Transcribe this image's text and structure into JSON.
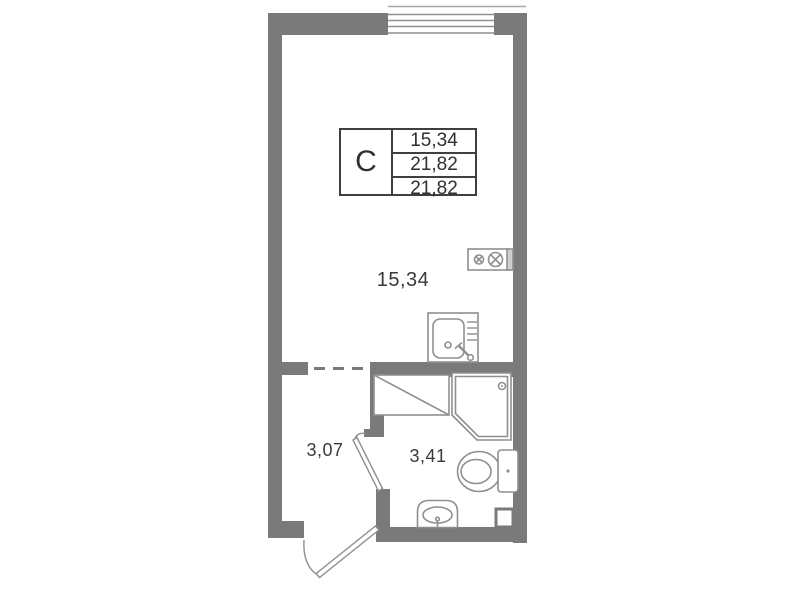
{
  "colors": {
    "background": "#ffffff",
    "wall": "#7a7a7a",
    "fixture_line": "#8f8f8f",
    "text": "#3a3a3a",
    "legend_border": "#3f3f3f"
  },
  "legend": {
    "type_label": "С",
    "values": [
      "15,34",
      "21,82",
      "21,82"
    ]
  },
  "rooms": {
    "living": {
      "area_label": "15,34"
    },
    "hallway": {
      "area_label": "3,07"
    },
    "bathroom": {
      "area_label": "3,41"
    }
  },
  "fixtures": [
    "window",
    "stove-icon",
    "kitchen-sink-icon",
    "shower-cabin-icon",
    "toilet-icon",
    "washbasin-icon",
    "vent-duct",
    "entrance-door",
    "bathroom-door",
    "zone-boundary-dashed-line"
  ]
}
